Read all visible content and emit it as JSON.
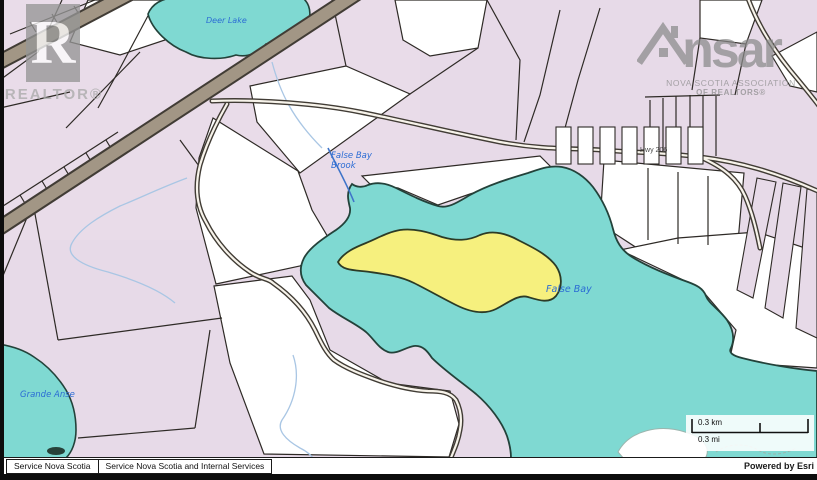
{
  "branding": {
    "realtor_letter": "R",
    "realtor_caption": "REALTOR®",
    "nsar_left": "ns",
    "nsar_right": "ar",
    "nsar_caption1": "NOVA SCOTIA ASSOCIATION",
    "nsar_caption2": "OF REALTORS®"
  },
  "map": {
    "labels": {
      "lake": "Deer Lake",
      "brook_line1": "False Bay",
      "brook_line2": "Brook",
      "bay": "False Bay",
      "cove": "Grande Anse",
      "road": "Hwy 206"
    },
    "colors": {
      "water": "#7fd9d2",
      "water_outline": "#23423a",
      "parcel_pink": "#e7dae8",
      "parcel_pink2": "#ecdeea",
      "parcel_white": "#ffffff",
      "highlight_yellow": "#f6f07e",
      "highlight_outline": "#2c3b26",
      "road_wide_fill": "#a29685",
      "road_edge": "#413c35",
      "road_core": "#f7f3ea",
      "line": "#2e2a26",
      "stream": "#a9c6e4",
      "brook": "#3f74c9",
      "label_blue": "#2b6cd4",
      "watermark_grey": "#969696",
      "footer_ink": "#111111"
    }
  },
  "scale_bar": {
    "km": "0.3 km",
    "mi": "0.3 mi"
  },
  "footer": {
    "left_primary": "Service Nova Scotia",
    "left_secondary": "Service Nova Scotia and Internal Services",
    "powered_by": "Powered by Esri"
  }
}
